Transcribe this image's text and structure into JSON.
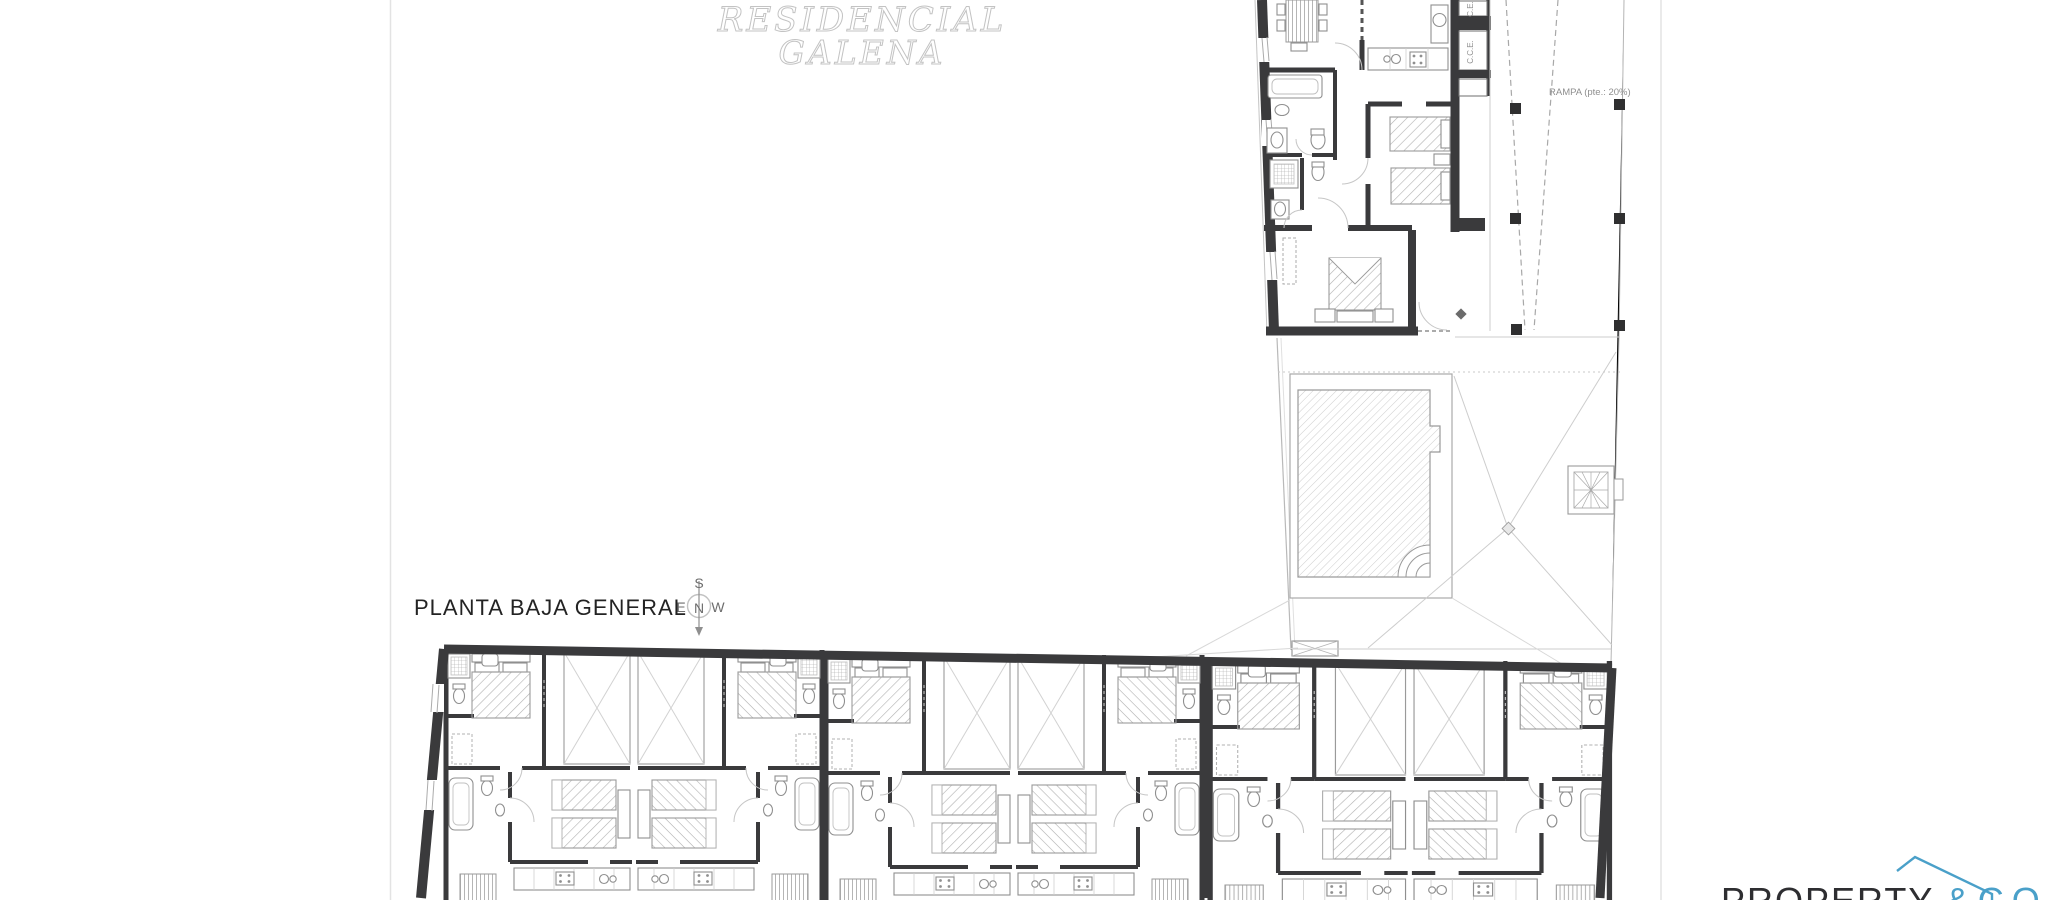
{
  "sheet": {
    "plan_title": "PLANTA BAJA GENERAL",
    "watermark_line1": "RESIDENCIAL",
    "watermark_line2": "GALENA"
  },
  "compass": {
    "north": "N",
    "south": "S",
    "east": "E",
    "west": "W"
  },
  "annotations": {
    "ramp_label": "RAMPA (pte.: 20%)",
    "closet_label_top": "C.E.",
    "closet_label_bottom": "C.C.E."
  },
  "logo": {
    "brand": "PROPERTY",
    "suffix": "&CO",
    "brand_color": "#2e2e31",
    "accent_color": "#4aa0c9"
  },
  "palette": {
    "wall": "#3a3a3c",
    "fixture_line": "#8f8f8f",
    "thin_line": "#9a9a9a",
    "faint_line": "#cdcdcd",
    "hatch": "#b0b0b0",
    "label_dark": "#232323",
    "label_muted": "#8f8f8f",
    "watermark_stroke": "#c3c3c3",
    "background": "#ffffff"
  }
}
